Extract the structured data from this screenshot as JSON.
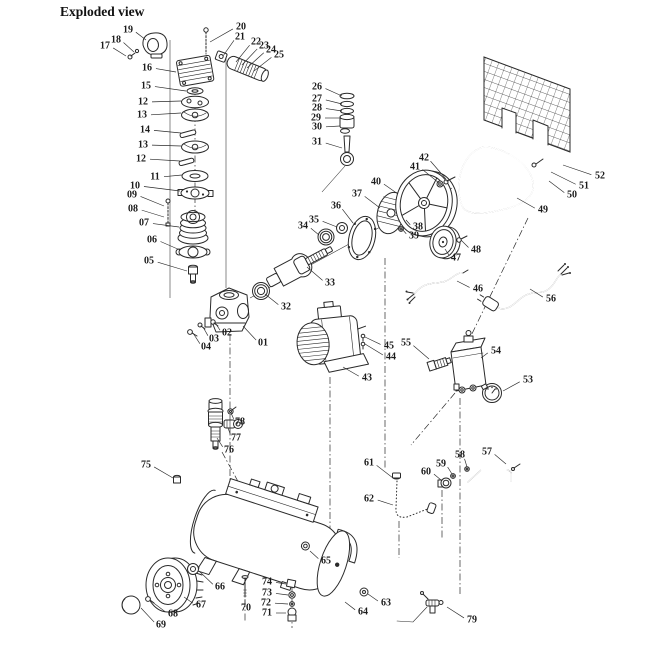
{
  "title": "Exploded view",
  "colors": {
    "ink": "#2a2a2a",
    "background": "#ffffff"
  },
  "diagram": {
    "labels": [
      {
        "n": "01",
        "x": 263,
        "y": 343,
        "tx": 243,
        "ty": 326
      },
      {
        "n": "02",
        "x": 227,
        "y": 333,
        "tx": 216,
        "ty": 324
      },
      {
        "n": "03",
        "x": 214,
        "y": 339,
        "tx": 203,
        "ty": 327
      },
      {
        "n": "04",
        "x": 206,
        "y": 347,
        "tx": 193,
        "ty": 333
      },
      {
        "n": "05",
        "x": 149,
        "y": 261,
        "tx": 187,
        "ty": 271
      },
      {
        "n": "06",
        "x": 152,
        "y": 240,
        "tx": 180,
        "ty": 250
      },
      {
        "n": "07",
        "x": 144,
        "y": 223,
        "tx": 179,
        "ty": 227
      },
      {
        "n": "08",
        "x": 133,
        "y": 209,
        "tx": 164,
        "ty": 217
      },
      {
        "n": "09",
        "x": 132,
        "y": 195,
        "tx": 164,
        "ty": 206
      },
      {
        "n": "10",
        "x": 135,
        "y": 186,
        "tx": 180,
        "ty": 191
      },
      {
        "n": "11",
        "x": 155,
        "y": 177,
        "tx": 182,
        "ty": 175
      },
      {
        "n": "12",
        "x": 143,
        "y": 102,
        "tx": 181,
        "ty": 101
      },
      {
        "n": "13",
        "x": 142,
        "y": 115,
        "tx": 181,
        "ty": 113
      },
      {
        "n": "14",
        "x": 145,
        "y": 130,
        "tx": 181,
        "ty": 133
      },
      {
        "n": "13",
        "x": 143,
        "y": 145,
        "tx": 181,
        "ty": 146
      },
      {
        "n": "12",
        "x": 141,
        "y": 159,
        "tx": 180,
        "ty": 161
      },
      {
        "n": "15",
        "x": 146,
        "y": 86,
        "tx": 186,
        "ty": 91
      },
      {
        "n": "16",
        "x": 147,
        "y": 68,
        "tx": 176,
        "ty": 72
      },
      {
        "n": "17",
        "x": 105,
        "y": 46,
        "tx": 126,
        "ty": 56
      },
      {
        "n": "18",
        "x": 116,
        "y": 40,
        "tx": 134,
        "ty": 52
      },
      {
        "n": "19",
        "x": 128,
        "y": 30,
        "tx": 146,
        "ty": 40
      },
      {
        "n": "20",
        "x": 241,
        "y": 27,
        "tx": 210,
        "ty": 42
      },
      {
        "n": "21",
        "x": 240,
        "y": 37,
        "tx": 223,
        "ty": 56
      },
      {
        "n": "22",
        "x": 256,
        "y": 42,
        "tx": 236,
        "ty": 62
      },
      {
        "n": "23",
        "x": 264,
        "y": 46,
        "tx": 242,
        "ty": 65
      },
      {
        "n": "24",
        "x": 271,
        "y": 50,
        "tx": 247,
        "ty": 68
      },
      {
        "n": "25",
        "x": 279,
        "y": 55,
        "tx": 254,
        "ty": 71
      },
      {
        "n": "26",
        "x": 317,
        "y": 87,
        "tx": 342,
        "ty": 96
      },
      {
        "n": "27",
        "x": 317,
        "y": 99,
        "tx": 342,
        "ty": 104
      },
      {
        "n": "28",
        "x": 317,
        "y": 108,
        "tx": 342,
        "ty": 111
      },
      {
        "n": "29",
        "x": 316,
        "y": 118,
        "tx": 341,
        "ty": 118
      },
      {
        "n": "30",
        "x": 317,
        "y": 127,
        "tx": 340,
        "ty": 126
      },
      {
        "n": "31",
        "x": 317,
        "y": 142,
        "tx": 342,
        "ty": 148
      },
      {
        "n": "32",
        "x": 286,
        "y": 307,
        "tx": 265,
        "ty": 294
      },
      {
        "n": "33",
        "x": 330,
        "y": 283,
        "tx": 307,
        "ty": 267
      },
      {
        "n": "34",
        "x": 303,
        "y": 226,
        "tx": 319,
        "ty": 235
      },
      {
        "n": "35",
        "x": 314,
        "y": 220,
        "tx": 337,
        "ty": 227
      },
      {
        "n": "36",
        "x": 336,
        "y": 206,
        "tx": 353,
        "ty": 223
      },
      {
        "n": "37",
        "x": 357,
        "y": 194,
        "tx": 380,
        "ty": 208
      },
      {
        "n": "38",
        "x": 418,
        "y": 227,
        "tx": 406,
        "ty": 220
      },
      {
        "n": "39",
        "x": 414,
        "y": 236,
        "tx": 402,
        "ty": 229
      },
      {
        "n": "40",
        "x": 376,
        "y": 182,
        "tx": 398,
        "ty": 194
      },
      {
        "n": "41",
        "x": 415,
        "y": 167,
        "tx": 439,
        "ty": 183
      },
      {
        "n": "42",
        "x": 424,
        "y": 158,
        "tx": 446,
        "ty": 179
      },
      {
        "n": "43",
        "x": 367,
        "y": 378,
        "tx": 343,
        "ty": 367
      },
      {
        "n": "44",
        "x": 391,
        "y": 357,
        "tx": 365,
        "ty": 344
      },
      {
        "n": "45",
        "x": 389,
        "y": 346,
        "tx": 365,
        "ty": 337
      },
      {
        "n": "46",
        "x": 478,
        "y": 289,
        "tx": 457,
        "ty": 281
      },
      {
        "n": "47",
        "x": 456,
        "y": 258,
        "tx": 445,
        "ty": 249
      },
      {
        "n": "48",
        "x": 476,
        "y": 250,
        "tx": 461,
        "ty": 240
      },
      {
        "n": "49",
        "x": 543,
        "y": 210,
        "tx": 517,
        "ty": 198
      },
      {
        "n": "50",
        "x": 572,
        "y": 195,
        "tx": 549,
        "ty": 181
      },
      {
        "n": "51",
        "x": 584,
        "y": 186,
        "tx": 551,
        "ty": 172
      },
      {
        "n": "52",
        "x": 600,
        "y": 176,
        "tx": 563,
        "ty": 165
      },
      {
        "n": "53",
        "x": 528,
        "y": 380,
        "tx": 503,
        "ty": 391
      },
      {
        "n": "54",
        "x": 496,
        "y": 351,
        "tx": 481,
        "ty": 358
      },
      {
        "n": "55",
        "x": 406,
        "y": 343,
        "tx": 429,
        "ty": 359
      },
      {
        "n": "56",
        "x": 551,
        "y": 299,
        "tx": 530,
        "ty": 289
      },
      {
        "n": "57",
        "x": 487,
        "y": 452,
        "tx": 506,
        "ty": 464
      },
      {
        "n": "58",
        "x": 460,
        "y": 455,
        "tx": 467,
        "ty": 467
      },
      {
        "n": "59",
        "x": 441,
        "y": 464,
        "tx": 452,
        "ty": 474
      },
      {
        "n": "60",
        "x": 426,
        "y": 472,
        "tx": 441,
        "ty": 480
      },
      {
        "n": "61",
        "x": 369,
        "y": 463,
        "tx": 393,
        "ty": 478
      },
      {
        "n": "62",
        "x": 369,
        "y": 499,
        "tx": 393,
        "ty": 505
      },
      {
        "n": "63",
        "x": 386,
        "y": 603,
        "tx": 368,
        "ty": 594
      },
      {
        "n": "64",
        "x": 363,
        "y": 612,
        "tx": 345,
        "ty": 602
      },
      {
        "n": "65",
        "x": 326,
        "y": 561,
        "tx": 310,
        "ty": 551
      },
      {
        "n": "66",
        "x": 220,
        "y": 587,
        "tx": 199,
        "ty": 571
      },
      {
        "n": "67",
        "x": 201,
        "y": 605,
        "tx": 184,
        "ty": 597
      },
      {
        "n": "68",
        "x": 173,
        "y": 614,
        "tx": 151,
        "ty": 601
      },
      {
        "n": "69",
        "x": 161,
        "y": 625,
        "tx": 141,
        "ty": 608
      },
      {
        "n": "70",
        "x": 246,
        "y": 608,
        "tx": 245,
        "ty": 599
      },
      {
        "n": "71",
        "x": 267,
        "y": 613,
        "tx": 286,
        "ty": 613
      },
      {
        "n": "72",
        "x": 266,
        "y": 603,
        "tx": 288,
        "ty": 604
      },
      {
        "n": "73",
        "x": 267,
        "y": 593,
        "tx": 288,
        "ty": 595
      },
      {
        "n": "74",
        "x": 267,
        "y": 582,
        "tx": 286,
        "ty": 584
      },
      {
        "n": "75",
        "x": 146,
        "y": 465,
        "tx": 173,
        "ty": 478
      },
      {
        "n": "76",
        "x": 229,
        "y": 450,
        "tx": 217,
        "ty": 438
      },
      {
        "n": "77",
        "x": 236,
        "y": 438,
        "tx": 228,
        "ty": 428
      },
      {
        "n": "78",
        "x": 240,
        "y": 422,
        "tx": 231,
        "ty": 413
      },
      {
        "n": "79",
        "x": 472,
        "y": 620,
        "tx": 447,
        "ty": 607
      }
    ],
    "guides": [
      {
        "x1": 195,
        "y1": 88,
        "x2": 195,
        "y2": 212,
        "k": "dd"
      },
      {
        "x1": 230,
        "y1": 334,
        "x2": 230,
        "y2": 497,
        "k": "dd"
      },
      {
        "x1": 330,
        "y1": 377,
        "x2": 330,
        "y2": 556,
        "k": "dd"
      },
      {
        "x1": 385,
        "y1": 258,
        "x2": 385,
        "y2": 470,
        "k": "dd"
      },
      {
        "x1": 460,
        "y1": 398,
        "x2": 460,
        "y2": 594,
        "k": "dd"
      },
      {
        "x1": 528,
        "y1": 218,
        "x2": 468,
        "y2": 342,
        "k": "dd"
      },
      {
        "x1": 292,
        "y1": 572,
        "x2": 292,
        "y2": 628,
        "k": "dd"
      },
      {
        "x1": 222,
        "y1": 452,
        "x2": 241,
        "y2": 487,
        "k": "dd"
      },
      {
        "x1": 455,
        "y1": 393,
        "x2": 411,
        "y2": 445,
        "k": "dd"
      },
      {
        "x1": 245,
        "y1": 600,
        "x2": 245,
        "y2": 623,
        "k": "dd"
      },
      {
        "x1": 442,
        "y1": 490,
        "x2": 442,
        "y2": 538,
        "k": "dd"
      },
      {
        "x1": 399,
        "y1": 521,
        "x2": 399,
        "y2": 558,
        "k": "dd"
      },
      {
        "x1": 170,
        "y1": 40,
        "x2": 170,
        "y2": 298,
        "k": "s"
      },
      {
        "x1": 226,
        "y1": 58,
        "x2": 226,
        "y2": 288,
        "k": "s"
      },
      {
        "x1": 250,
        "y1": 298,
        "x2": 452,
        "y2": 188,
        "k": "s"
      },
      {
        "x1": 345,
        "y1": 166,
        "x2": 322,
        "y2": 192,
        "k": "s"
      }
    ]
  }
}
